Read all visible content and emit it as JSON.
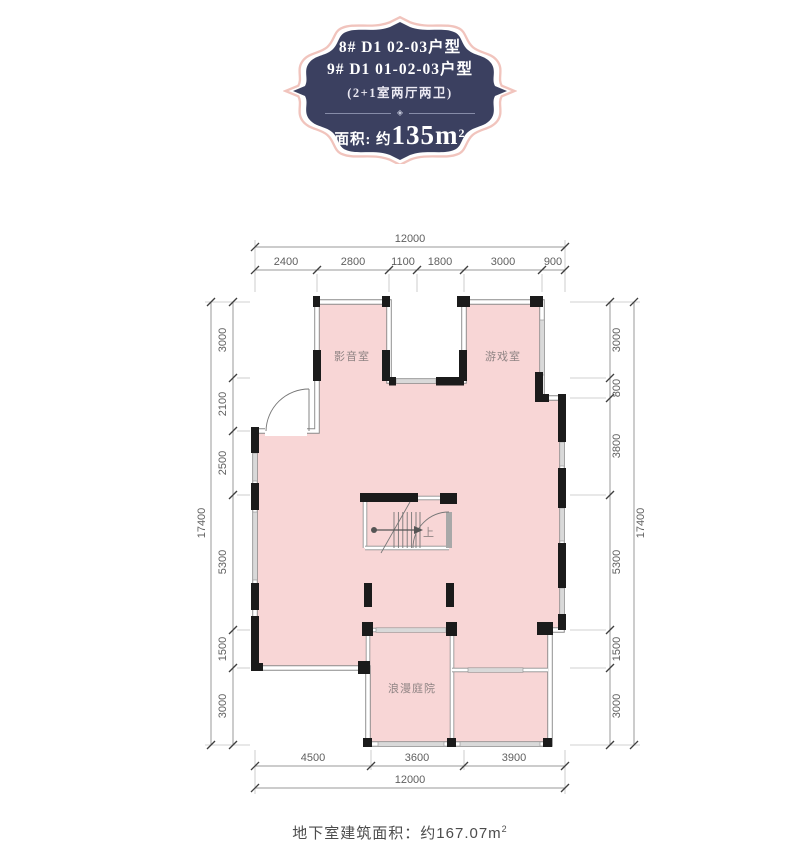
{
  "badge": {
    "line1": "8#  D1  02-03户型",
    "line2": "9#  D1  01-02-03户型",
    "spec": "(2+1室两厅两卫)",
    "ornament": "◈",
    "area_prefix": "面积: 约",
    "area_value": "135m",
    "area_sup": "2"
  },
  "plan": {
    "rooms": [
      {
        "label": "影音室"
      },
      {
        "label": "游戏室"
      },
      {
        "label": "浪漫庭院"
      }
    ],
    "stairs_label": "上"
  },
  "dims": {
    "top_total": "12000",
    "top_segments": [
      "2400",
      "2800",
      "1100",
      "1800",
      "3000",
      "900"
    ],
    "bottom_total": "12000",
    "bottom_segments": [
      "4500",
      "3600",
      "3900"
    ],
    "left_total": "17400",
    "left_segments": [
      "3000",
      "2100",
      "2500",
      "5300",
      "1500",
      "3000"
    ],
    "right_total": "17400",
    "right_segments": [
      "3000",
      "800",
      "3800",
      "5300",
      "1500",
      "3000"
    ]
  },
  "caption": {
    "text": "地下室建筑面积：约167.07m",
    "sup": "2"
  },
  "colors": {
    "floor": "#f8d6d6",
    "wall": "#1b1b1b",
    "badge_fill": "#3b4060",
    "badge_outline": "#f1c4bd"
  }
}
